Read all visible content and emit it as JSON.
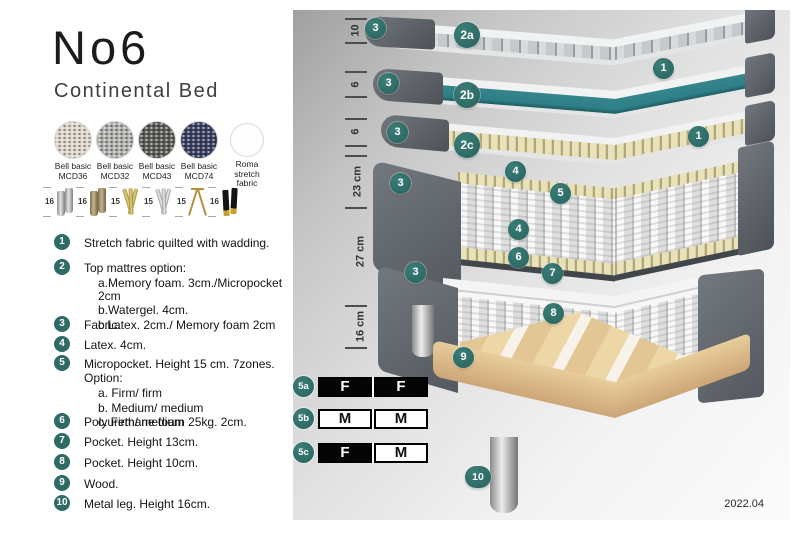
{
  "colors": {
    "accent": "#2e6b66",
    "watergel": "#2e7f87",
    "wood": "#e2c493",
    "dark_grey": "#565c63"
  },
  "header": {
    "title": "No6",
    "subtitle": "Continental Bed"
  },
  "fabrics": [
    {
      "line1": "Bell basic",
      "line2": "MCD36",
      "color": "#ddd7ca"
    },
    {
      "line1": "Bell basic",
      "line2": "MCD32",
      "color": "#b0b0ae"
    },
    {
      "line1": "Bell basic",
      "line2": "MCD43",
      "color": "#5f5e5b"
    },
    {
      "line1": "Bell basic",
      "line2": "MCD74",
      "color": "#3c4263"
    },
    {
      "line1": "Roma",
      "line2": "stretch fabric",
      "color": "#fdfdfd"
    }
  ],
  "legs": [
    {
      "height": "16",
      "style": "steel cylinder"
    },
    {
      "height": "16",
      "style": "brass cylinder"
    },
    {
      "height": "15",
      "style": "gold twist"
    },
    {
      "height": "15",
      "style": "silver twist"
    },
    {
      "height": "15",
      "style": "hairpin"
    },
    {
      "height": "16",
      "style": "black with gold tip"
    }
  ],
  "legend": [
    {
      "num": "1",
      "text": "Stretch fabric quilted with wadding.",
      "sub": []
    },
    {
      "num": "2",
      "text": "Top mattres option:",
      "sub": [
        "a.Memory foam. 3cm./Micropocket 2cm",
        "b.Watergel. 4cm.",
        "c.Latex. 2cm./ Memory foam 2cm"
      ]
    },
    {
      "num": "3",
      "text": "Fabric.",
      "sub": []
    },
    {
      "num": "4",
      "text": "Latex. 4cm.",
      "sub": []
    },
    {
      "num": "5",
      "text": "Micropocket. Height 15 cm. 7zones. Option:",
      "sub": [
        "a. Firm/ firm",
        "b. Medium/ medium",
        "c. Firm/ medium"
      ]
    },
    {
      "num": "6",
      "text": "Polyurethane foam 25kg. 2cm.",
      "sub": []
    },
    {
      "num": "7",
      "text": "Pocket. Height 13cm.",
      "sub": []
    },
    {
      "num": "8",
      "text": "Pocket. Height 10cm.",
      "sub": []
    },
    {
      "num": "9",
      "text": "Wood.",
      "sub": []
    },
    {
      "num": "10",
      "text": "Metal leg. Height 16cm.",
      "sub": []
    }
  ],
  "diagram": {
    "dimensions": [
      {
        "label": "10"
      },
      {
        "label": "6"
      },
      {
        "label": "6"
      },
      {
        "label": "23 cm"
      },
      {
        "label": "27 cm"
      },
      {
        "label": "16 cm"
      }
    ],
    "callouts": [
      {
        "label": "3"
      },
      {
        "label": "2a"
      },
      {
        "label": "1"
      },
      {
        "label": "3"
      },
      {
        "label": "2b"
      },
      {
        "label": "1"
      },
      {
        "label": "3"
      },
      {
        "label": "2c"
      },
      {
        "label": "4"
      },
      {
        "label": "3"
      },
      {
        "label": "5"
      },
      {
        "label": "4"
      },
      {
        "label": "6"
      },
      {
        "label": "3"
      },
      {
        "label": "7"
      },
      {
        "label": "8"
      },
      {
        "label": "9"
      },
      {
        "label": "10"
      }
    ],
    "firmness": [
      {
        "id": "5a",
        "cells": [
          {
            "label": "F",
            "bg": "#050505",
            "fg": "#ffffff"
          },
          {
            "label": "F",
            "bg": "#050505",
            "fg": "#ffffff"
          }
        ]
      },
      {
        "id": "5b",
        "cells": [
          {
            "label": "M",
            "bg": "#ffffff",
            "fg": "#111111"
          },
          {
            "label": "M",
            "bg": "#ffffff",
            "fg": "#111111"
          }
        ]
      },
      {
        "id": "5c",
        "cells": [
          {
            "label": "F",
            "bg": "#050505",
            "fg": "#ffffff"
          },
          {
            "label": "M",
            "bg": "#ffffff",
            "fg": "#111111"
          }
        ]
      }
    ],
    "version": "2022.04"
  }
}
